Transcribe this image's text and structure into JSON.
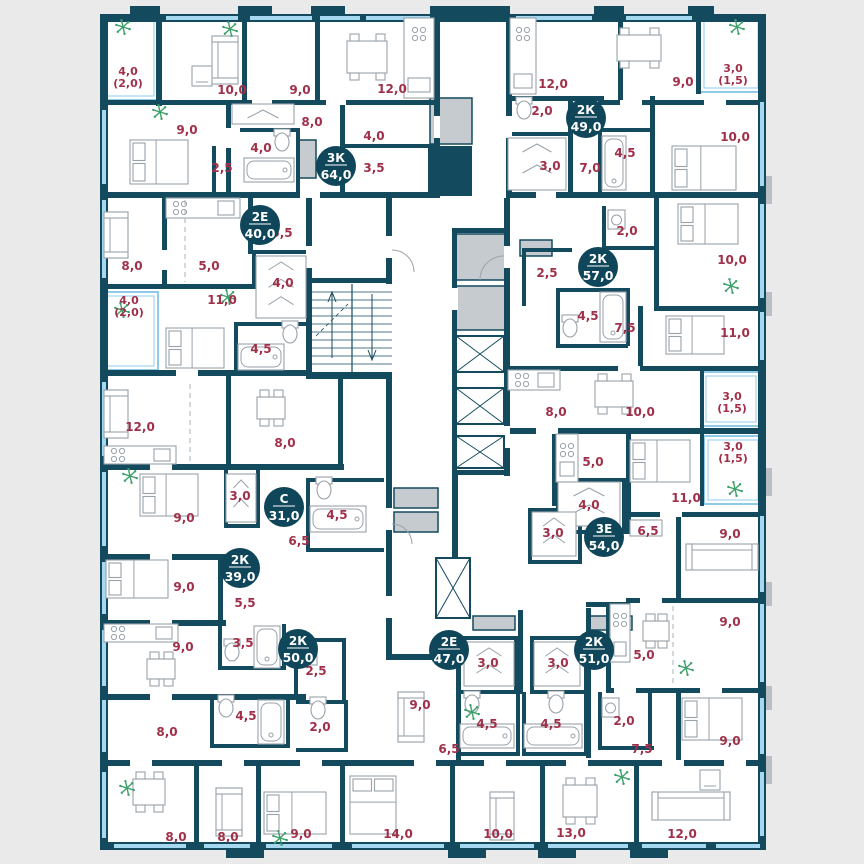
{
  "plan": {
    "colors": {
      "wall": "#144a5e",
      "background": "#eaeaea",
      "room_label": "#a03049",
      "badge": "#0f4659",
      "badge_text": "#ffffff",
      "window": "#a6d8ef",
      "balcony": "#8fcbe9",
      "shaft": "#c6cbd0",
      "plant": "#3da06a",
      "furniture": "#98a2a9"
    },
    "units": [
      {
        "type": "3К",
        "area": "64,0",
        "x": 336,
        "y": 166
      },
      {
        "type": "2К",
        "area": "49,0",
        "x": 586,
        "y": 118
      },
      {
        "type": "2Е",
        "area": "40,0",
        "x": 260,
        "y": 225
      },
      {
        "type": "2К",
        "area": "57,0",
        "x": 598,
        "y": 267
      },
      {
        "type": "С",
        "area": "31,0",
        "x": 284,
        "y": 507
      },
      {
        "type": "3Е",
        "area": "54,0",
        "x": 604,
        "y": 537
      },
      {
        "type": "2К",
        "area": "39,0",
        "x": 240,
        "y": 568
      },
      {
        "type": "2К",
        "area": "50,0",
        "x": 298,
        "y": 649
      },
      {
        "type": "2Е",
        "area": "47,0",
        "x": 449,
        "y": 650
      },
      {
        "type": "2К",
        "area": "51,0",
        "x": 594,
        "y": 650
      }
    ],
    "rooms": [
      {
        "label": "10,0",
        "x": 232,
        "y": 90
      },
      {
        "label": "9,0",
        "x": 300,
        "y": 90
      },
      {
        "label": "12,0",
        "x": 392,
        "y": 89
      },
      {
        "label": "12,0",
        "x": 553,
        "y": 84
      },
      {
        "label": "9,0",
        "x": 683,
        "y": 82
      },
      {
        "label": "9,0",
        "x": 187,
        "y": 130
      },
      {
        "label": "8,0",
        "x": 312,
        "y": 122
      },
      {
        "label": "4,0",
        "x": 374,
        "y": 136
      },
      {
        "label": "4,0",
        "x": 261,
        "y": 148
      },
      {
        "label": "2,5",
        "x": 222,
        "y": 168
      },
      {
        "label": "3,5",
        "x": 374,
        "y": 168
      },
      {
        "label": "2,0",
        "x": 542,
        "y": 111
      },
      {
        "label": "3,0",
        "x": 550,
        "y": 166
      },
      {
        "label": "4,5",
        "x": 625,
        "y": 153
      },
      {
        "label": "7,0",
        "x": 590,
        "y": 168
      },
      {
        "label": "10,0",
        "x": 735,
        "y": 137
      },
      {
        "label": "8,0",
        "x": 132,
        "y": 266
      },
      {
        "label": "5,0",
        "x": 209,
        "y": 266
      },
      {
        "label": "5,5",
        "x": 282,
        "y": 233
      },
      {
        "label": "4,0",
        "x": 283,
        "y": 283
      },
      {
        "label": "11,0",
        "x": 222,
        "y": 300
      },
      {
        "label": "4,5",
        "x": 261,
        "y": 349
      },
      {
        "label": "2,0",
        "x": 627,
        "y": 231
      },
      {
        "label": "2,5",
        "x": 547,
        "y": 273
      },
      {
        "label": "4,5",
        "x": 588,
        "y": 316
      },
      {
        "label": "7,5",
        "x": 625,
        "y": 328
      },
      {
        "label": "10,0",
        "x": 732,
        "y": 260
      },
      {
        "label": "11,0",
        "x": 735,
        "y": 333
      },
      {
        "label": "8,0",
        "x": 556,
        "y": 412
      },
      {
        "label": "10,0",
        "x": 640,
        "y": 412
      },
      {
        "label": "12,0",
        "x": 140,
        "y": 427
      },
      {
        "label": "8,0",
        "x": 285,
        "y": 443
      },
      {
        "label": "3,0",
        "x": 240,
        "y": 496
      },
      {
        "label": "9,0",
        "x": 184,
        "y": 518
      },
      {
        "label": "4,5",
        "x": 337,
        "y": 515
      },
      {
        "label": "6,5",
        "x": 299,
        "y": 541
      },
      {
        "label": "9,0",
        "x": 184,
        "y": 587
      },
      {
        "label": "5,5",
        "x": 245,
        "y": 603
      },
      {
        "label": "3,5",
        "x": 243,
        "y": 643
      },
      {
        "label": "9,0",
        "x": 183,
        "y": 647
      },
      {
        "label": "5,0",
        "x": 593,
        "y": 462
      },
      {
        "label": "4,0",
        "x": 589,
        "y": 505
      },
      {
        "label": "11,0",
        "x": 686,
        "y": 498
      },
      {
        "label": "3,0",
        "x": 553,
        "y": 533
      },
      {
        "label": "6,5",
        "x": 648,
        "y": 531
      },
      {
        "label": "9,0",
        "x": 730,
        "y": 534
      },
      {
        "label": "2,5",
        "x": 316,
        "y": 671
      },
      {
        "label": "4,5",
        "x": 246,
        "y": 716
      },
      {
        "label": "2,0",
        "x": 320,
        "y": 727
      },
      {
        "label": "8,0",
        "x": 167,
        "y": 732
      },
      {
        "label": "3,0",
        "x": 488,
        "y": 663
      },
      {
        "label": "9,0",
        "x": 420,
        "y": 705
      },
      {
        "label": "4,5",
        "x": 487,
        "y": 724
      },
      {
        "label": "6,5",
        "x": 449,
        "y": 749
      },
      {
        "label": "3,0",
        "x": 558,
        "y": 663
      },
      {
        "label": "5,0",
        "x": 644,
        "y": 655
      },
      {
        "label": "4,5",
        "x": 551,
        "y": 724
      },
      {
        "label": "9,0",
        "x": 730,
        "y": 622
      },
      {
        "label": "2,0",
        "x": 624,
        "y": 721
      },
      {
        "label": "7,5",
        "x": 642,
        "y": 749
      },
      {
        "label": "9,0",
        "x": 730,
        "y": 741
      },
      {
        "label": "8,0",
        "x": 176,
        "y": 837
      },
      {
        "label": "8,0",
        "x": 228,
        "y": 837
      },
      {
        "label": "9,0",
        "x": 301,
        "y": 834
      },
      {
        "label": "14,0",
        "x": 398,
        "y": 834
      },
      {
        "label": "10,0",
        "x": 498,
        "y": 834
      },
      {
        "label": "13,0",
        "x": 571,
        "y": 833
      },
      {
        "label": "12,0",
        "x": 682,
        "y": 834
      }
    ],
    "balconies": [
      {
        "area": "4,0",
        "inner": "(2,0)",
        "x": 128,
        "y": 71
      },
      {
        "area": "3,0",
        "inner": "(1,5)",
        "x": 733,
        "y": 68
      },
      {
        "area": "4,0",
        "inner": "(2,0)",
        "x": 129,
        "y": 300
      },
      {
        "area": "3,0",
        "inner": "(1,5)",
        "x": 732,
        "y": 396
      },
      {
        "area": "3,0",
        "inner": "(1,5)",
        "x": 733,
        "y": 446
      }
    ]
  }
}
